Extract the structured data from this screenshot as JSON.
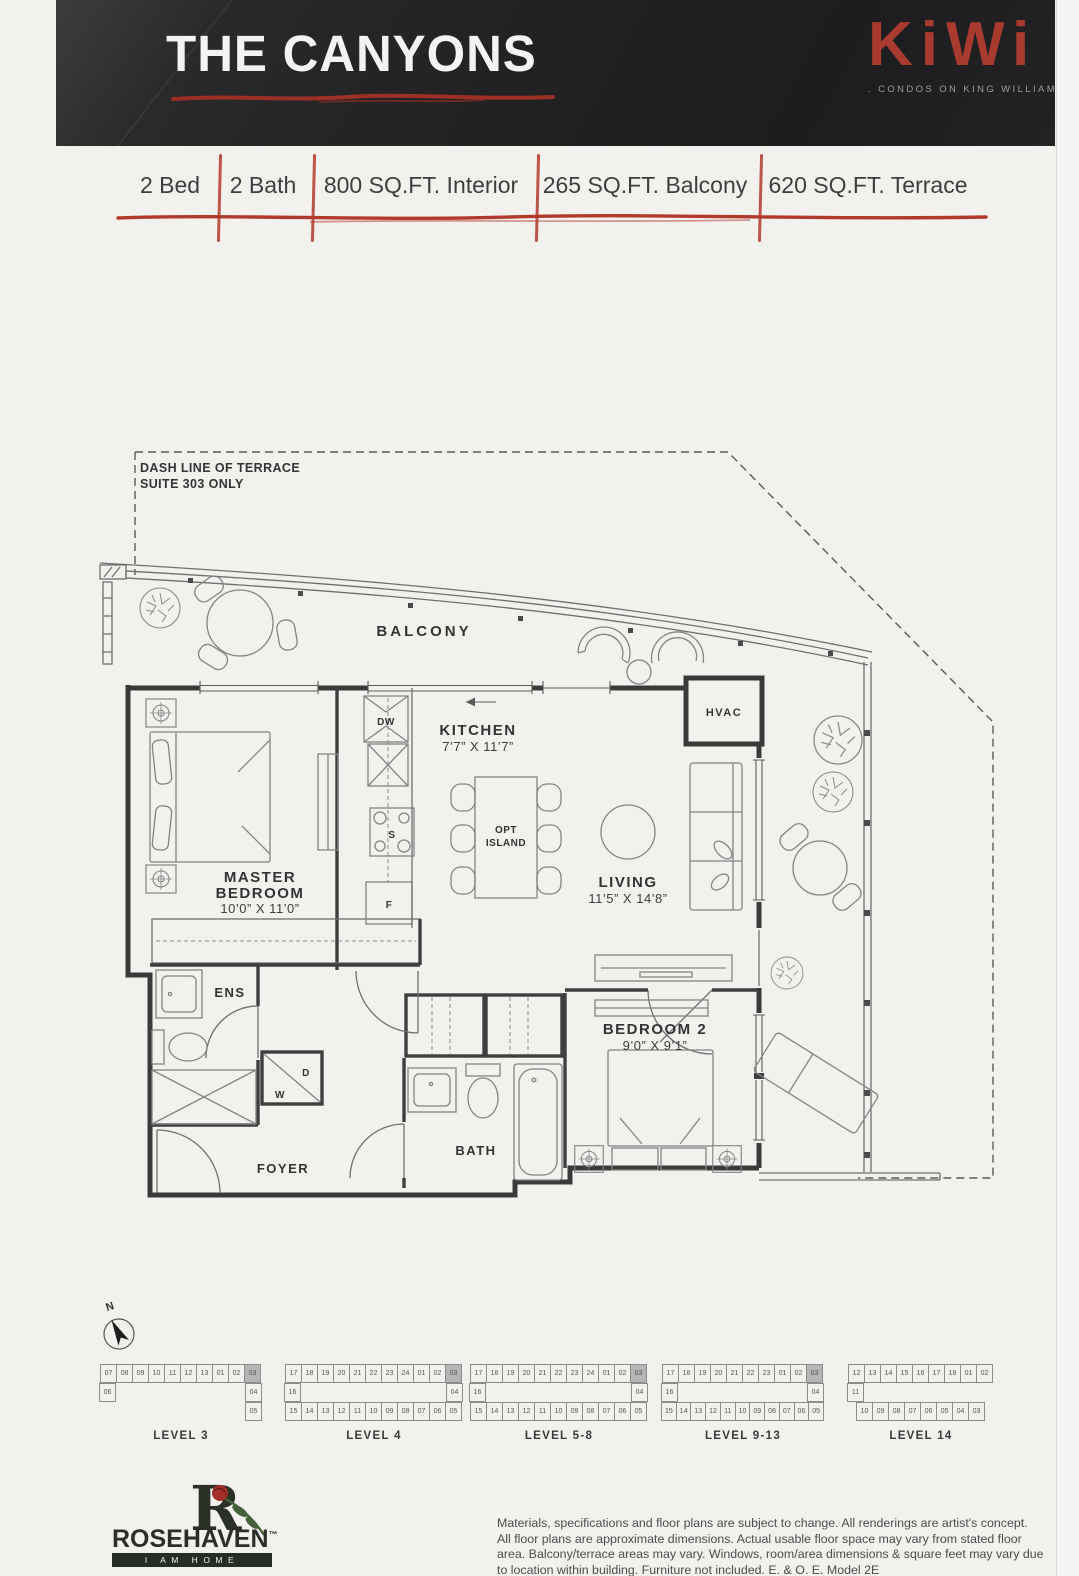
{
  "header": {
    "title": "THE CANYONS",
    "brand": {
      "name": "KiWi",
      "tagline": ". CONDOS ON KING WILLIAM"
    },
    "colors": {
      "banner_bg": "#232324",
      "title_text": "#f3f3f1",
      "accent_red": "#b23a2c",
      "brand_red": "#a93a30",
      "tagline_gray": "#9c9c9c"
    }
  },
  "specs": {
    "items": [
      "2 Bed",
      "2 Bath",
      "800 SQ.FT. Interior",
      "265 SQ.FT. Balcony",
      "620 SQ.FT. Terrace"
    ]
  },
  "floorplan": {
    "note1": "DASH LINE OF TERRACE",
    "note2": "SUITE 303 ONLY",
    "balcony": "BALCONY",
    "kitchen": "KITCHEN",
    "kitchen_dims": "7’7” X 11’7”",
    "master1": "MASTER",
    "master2": "BEDROOM",
    "master_dims": "10’0” X 11’0”",
    "living": "LIVING",
    "living_dims": "11’5” X 14’8”",
    "bedroom2": "BEDROOM 2",
    "bedroom2_dims": "9’0” X 9’1”",
    "ens": "ENS",
    "foyer": "FOYER",
    "bath": "BATH",
    "hvac": "HVAC",
    "opt1": "OPT",
    "opt2": "ISLAND",
    "dw": "DW",
    "stove": "S",
    "fridge": "F",
    "dryer": "D",
    "washer": "W",
    "north": "N"
  },
  "keyplans": {
    "highlight_color": "#b5b5b5",
    "levels": [
      {
        "label": "LEVEL 3",
        "highlight": "03",
        "rows": [
          [
            "07",
            "08",
            "09",
            "10",
            "11",
            "12",
            "13",
            "01",
            "02",
            "03"
          ],
          [
            "06",
            "04"
          ],
          [
            "05"
          ]
        ]
      },
      {
        "label": "LEVEL 4",
        "highlight": "03",
        "rows": [
          [
            "17",
            "18",
            "19",
            "20",
            "21",
            "22",
            "23",
            "24",
            "01",
            "02",
            "03"
          ],
          [
            "16",
            "04"
          ],
          [
            "15",
            "14",
            "13",
            "12",
            "11",
            "10",
            "09",
            "08",
            "07",
            "06",
            "05"
          ]
        ]
      },
      {
        "label": "LEVEL 5-8",
        "highlight": "03",
        "rows": [
          [
            "17",
            "18",
            "19",
            "20",
            "21",
            "22",
            "23",
            "24",
            "01",
            "02",
            "03"
          ],
          [
            "16",
            "04"
          ],
          [
            "15",
            "14",
            "13",
            "12",
            "11",
            "10",
            "09",
            "08",
            "07",
            "06",
            "05"
          ]
        ]
      },
      {
        "label": "LEVEL 9-13",
        "highlight": "03",
        "rows": [
          [
            "17",
            "18",
            "19",
            "20",
            "21",
            "22",
            "23",
            "01",
            "02",
            "03"
          ],
          [
            "16",
            "04"
          ],
          [
            "15",
            "14",
            "13",
            "12",
            "11",
            "10",
            "09",
            "08",
            "07",
            "06",
            "05"
          ]
        ]
      },
      {
        "label": "LEVEL 14",
        "highlight": "",
        "rows": [
          [
            "12",
            "13",
            "14",
            "15",
            "16",
            "17",
            "18",
            "01",
            "02"
          ],
          [
            "11"
          ],
          [
            "10",
            "09",
            "08",
            "07",
            "06",
            "05",
            "04",
            "03"
          ]
        ]
      }
    ]
  },
  "footer": {
    "rosehaven": {
      "monogram": "R",
      "name": "ROSEHAVEN",
      "tm": "™",
      "tagline": "I AM HOME"
    },
    "disclaimer": [
      "Materials, specifications and floor plans are subject to change. All renderings are artist's concept.",
      "All floor plans are approximate dimensions. Actual usable floor space may vary from stated floor",
      "area. Balcony/terrace areas may vary. Windows, room/area dimensions & square feet may vary due",
      "to location within building. Furniture not included. E. & O. E. Model 2E"
    ]
  }
}
